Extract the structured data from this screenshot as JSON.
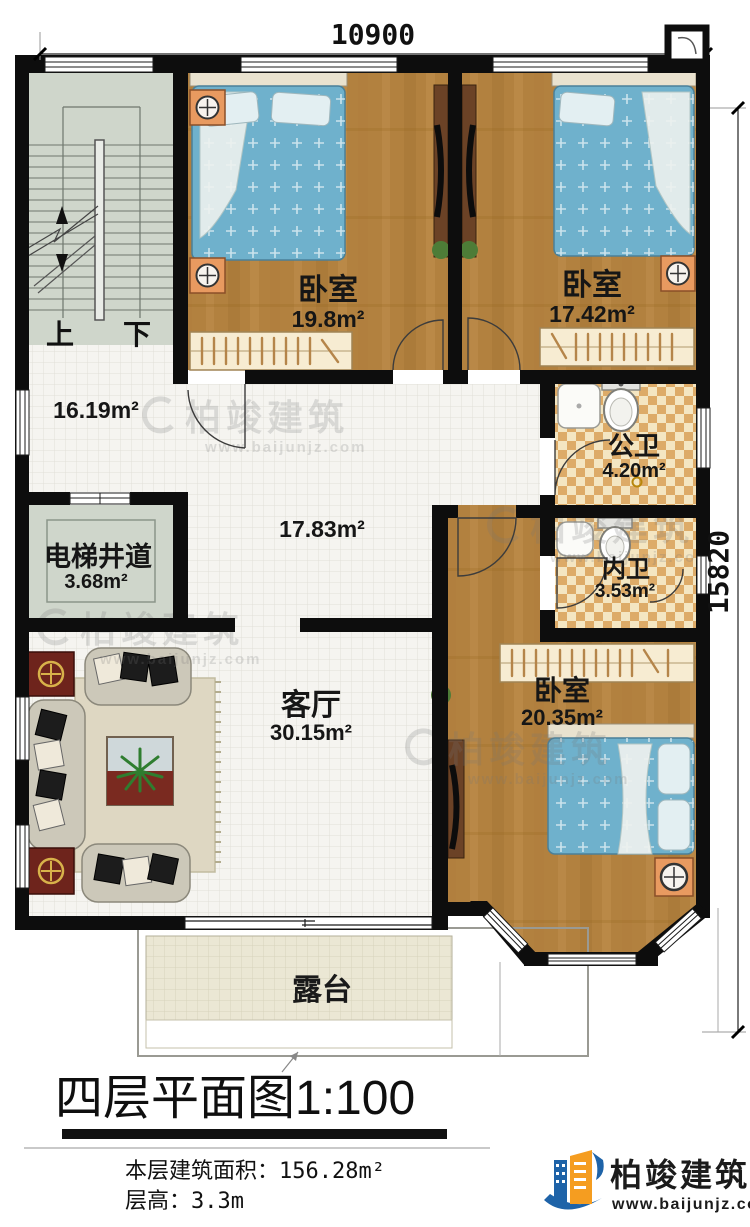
{
  "dimensions": {
    "top": "10900",
    "right": "15820"
  },
  "stairs": {
    "up": "上",
    "down": "下"
  },
  "rooms": {
    "bedroom_top_left": {
      "name": "卧室",
      "area": "19.8m²"
    },
    "bedroom_top_right": {
      "name": "卧室",
      "area": "17.42m²"
    },
    "bedroom_bottom": {
      "name": "卧室",
      "area": "20.35m²"
    },
    "stair_hall": {
      "area": "16.19m²"
    },
    "hall": {
      "area": "17.83m²"
    },
    "public_bathroom": {
      "name": "公卫",
      "area": "4.20m²"
    },
    "inner_bathroom": {
      "name": "内卫",
      "area": "3.53m²"
    },
    "elevator_shaft": {
      "name": "电梯井道",
      "area": "3.68m²"
    },
    "living_room": {
      "name": "客厅",
      "area": "30.15m²"
    },
    "terrace": {
      "name": "露台"
    }
  },
  "title": {
    "text": "四层平面图",
    "scale": "1:100"
  },
  "footer": {
    "floor_area_label": "本层建筑面积：",
    "floor_area_value": "156.28m²",
    "floor_height_label": "层高：",
    "floor_height_value": "3.3m"
  },
  "brand": {
    "name": "柏竣建筑",
    "website": "www.baijunjz.com"
  },
  "watermark": {
    "name": "柏竣建筑",
    "website": "www.baijunjz.com"
  },
  "colors": {
    "wall": "#0d0d0d",
    "wood_floor": "#b2813f",
    "tile_floor": "#f5f4f0",
    "bathroom_tile": "#e8c588",
    "stair_floor": "#cfd6cb",
    "terrace_floor": "#ebe7d4",
    "bed_blue": "#6fb1cc",
    "furniture_orange": "#e89a60",
    "brand_blue": "#1e63a8",
    "brand_orange": "#f59d20"
  }
}
